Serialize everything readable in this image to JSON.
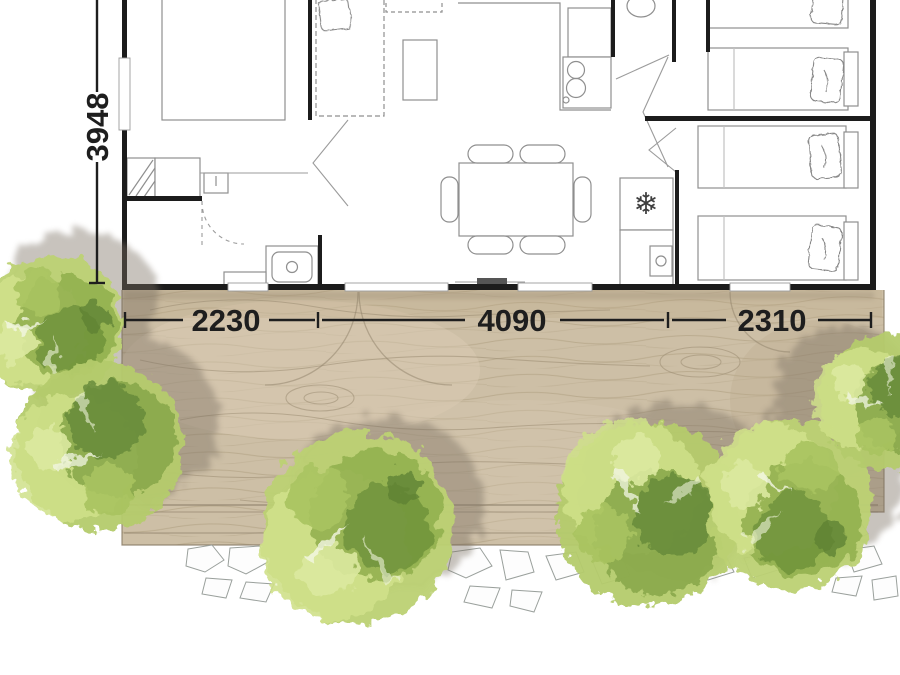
{
  "floor_plan": {
    "type": "mobile-home-top-view-plan",
    "dimensions": {
      "height_label": "3948",
      "width_segments": [
        {
          "label": "2230"
        },
        {
          "label": "4090"
        },
        {
          "label": "2310"
        }
      ]
    },
    "icons": {
      "freezer": "❄"
    },
    "colors": {
      "wall": "#1c1c1c",
      "dimension_text": "#1e1e1e",
      "furniture_line": "#8f8f8f",
      "deck_wood": "#cdbfa6",
      "wood_grain": "#9c8d73",
      "tree_light": "#cfe08a",
      "tree_mid": "#8fae4c",
      "tree_dark": "#5d8034",
      "shadow": "#7b7163",
      "stone_outline": "#9aa09c"
    }
  }
}
